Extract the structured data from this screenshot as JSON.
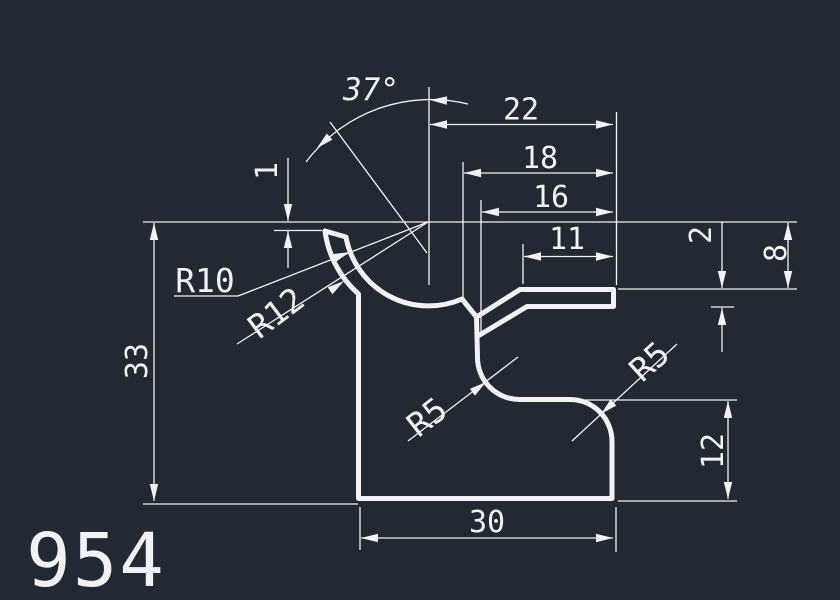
{
  "part_number": "954",
  "colors": {
    "background": "#232932",
    "line": "#f0f3f6"
  },
  "angle": {
    "label": "37°"
  },
  "radii": {
    "r10": "R10",
    "r12": "R12",
    "r5_left": "R5",
    "r5_right": "R5"
  },
  "dims": {
    "d22": "22",
    "d18": "18",
    "d16": "16",
    "d11": "11",
    "d2": "2",
    "d8": "8",
    "d1": "1",
    "d33": "33",
    "d30": "30",
    "d12": "12"
  }
}
